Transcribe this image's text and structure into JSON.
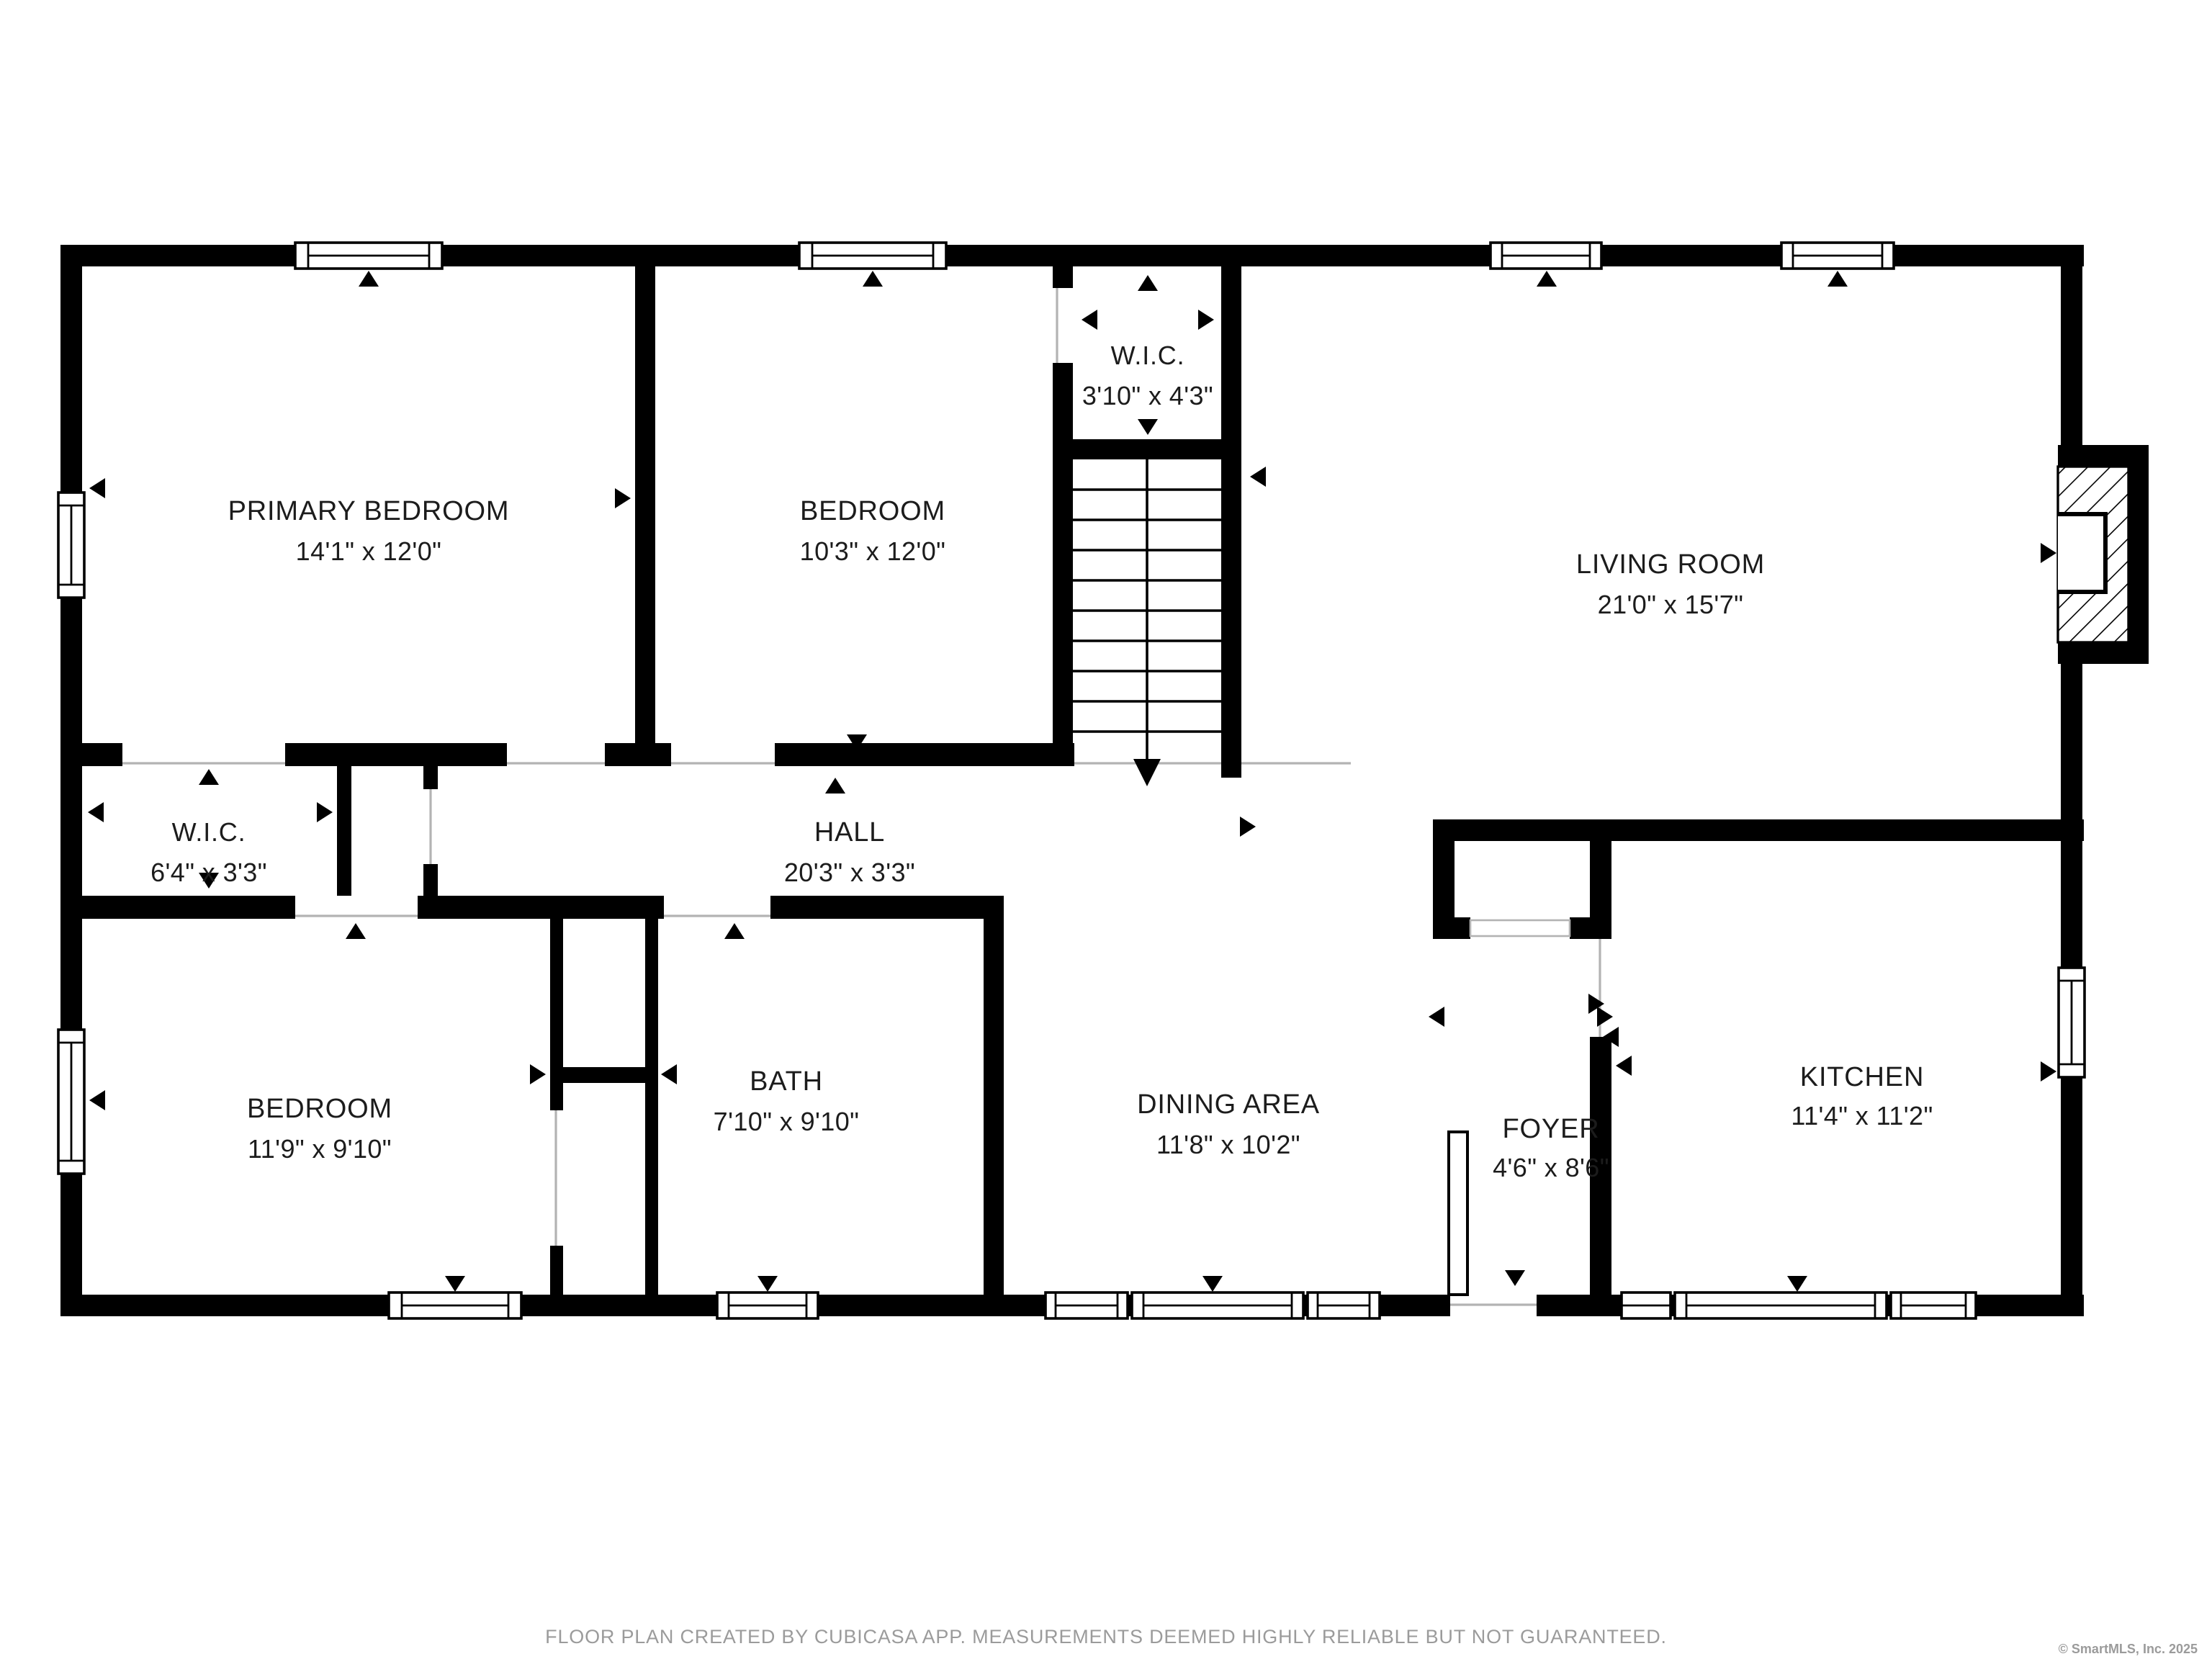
{
  "title": "Floor plan",
  "colors": {
    "wall": "#000000",
    "text": "#1c1c1c",
    "muted_text": "#9b9b9b",
    "background": "#ffffff",
    "door_opening_line": "#b3b3b3"
  },
  "rooms": [
    {
      "id": "primary-bedroom",
      "name": "PRIMARY BEDROOM",
      "dims": "14'1\" x 12'0\""
    },
    {
      "id": "bedroom-top",
      "name": "BEDROOM",
      "dims": "10'3\" x 12'0\""
    },
    {
      "id": "wic-top",
      "name": "W.I.C.",
      "dims": "3'10\" x 4'3\""
    },
    {
      "id": "living-room",
      "name": "LIVING ROOM",
      "dims": "21'0\" x 15'7\""
    },
    {
      "id": "wic-left",
      "name": "W.I.C.",
      "dims": "6'4\" x 3'3\""
    },
    {
      "id": "hall",
      "name": "HALL",
      "dims": "20'3\" x 3'3\""
    },
    {
      "id": "bedroom-bottom",
      "name": "BEDROOM",
      "dims": "11'9\" x 9'10\""
    },
    {
      "id": "bath",
      "name": "BATH",
      "dims": "7'10\" x 9'10\""
    },
    {
      "id": "dining-area",
      "name": "DINING AREA",
      "dims": "11'8\" x 10'2\""
    },
    {
      "id": "foyer",
      "name": "FOYER",
      "dims": "4'6\" x 8'6\""
    },
    {
      "id": "kitchen",
      "name": "KITCHEN",
      "dims": "11'4\" x 11'2\""
    }
  ],
  "stairs": {
    "treads": 9,
    "direction": "down"
  },
  "footer": {
    "note": "FLOOR PLAN CREATED BY CUBICASA APP. MEASUREMENTS DEEMED HIGHLY RELIABLE BUT NOT GUARANTEED.",
    "copyright": "© SmartMLS, Inc.  2025"
  }
}
